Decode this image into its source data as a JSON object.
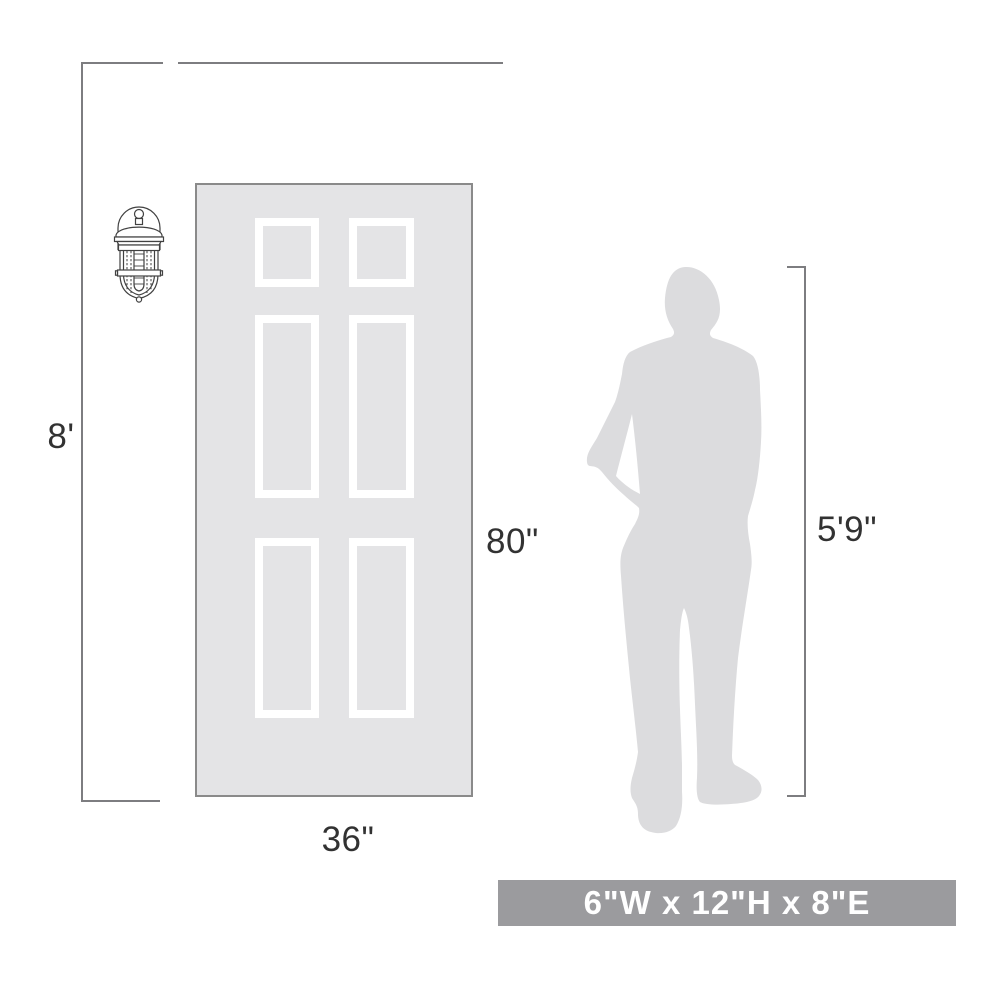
{
  "diagram_title": "wall sconce size-comparison diagram",
  "labels": {
    "wall_height": "8'",
    "door_height": "80\"",
    "door_width": "36\"",
    "person_height": "5'9\""
  },
  "banner": {
    "text": "6\"W x 12\"H x 8\"E"
  },
  "icons": {
    "sconce": "wall-sconce-icon",
    "person": "person-silhouette"
  },
  "colors": {
    "text": "#323232",
    "line": "#7d7d80",
    "door_fill": "#e4e4e6",
    "door_border": "#8a8a8a",
    "panel_frame": "#ffffff",
    "silhouette": "#dcdcde",
    "sconce_stroke": "#414141",
    "banner_bg": "#9b9b9e",
    "banner_text": "#ffffff"
  }
}
